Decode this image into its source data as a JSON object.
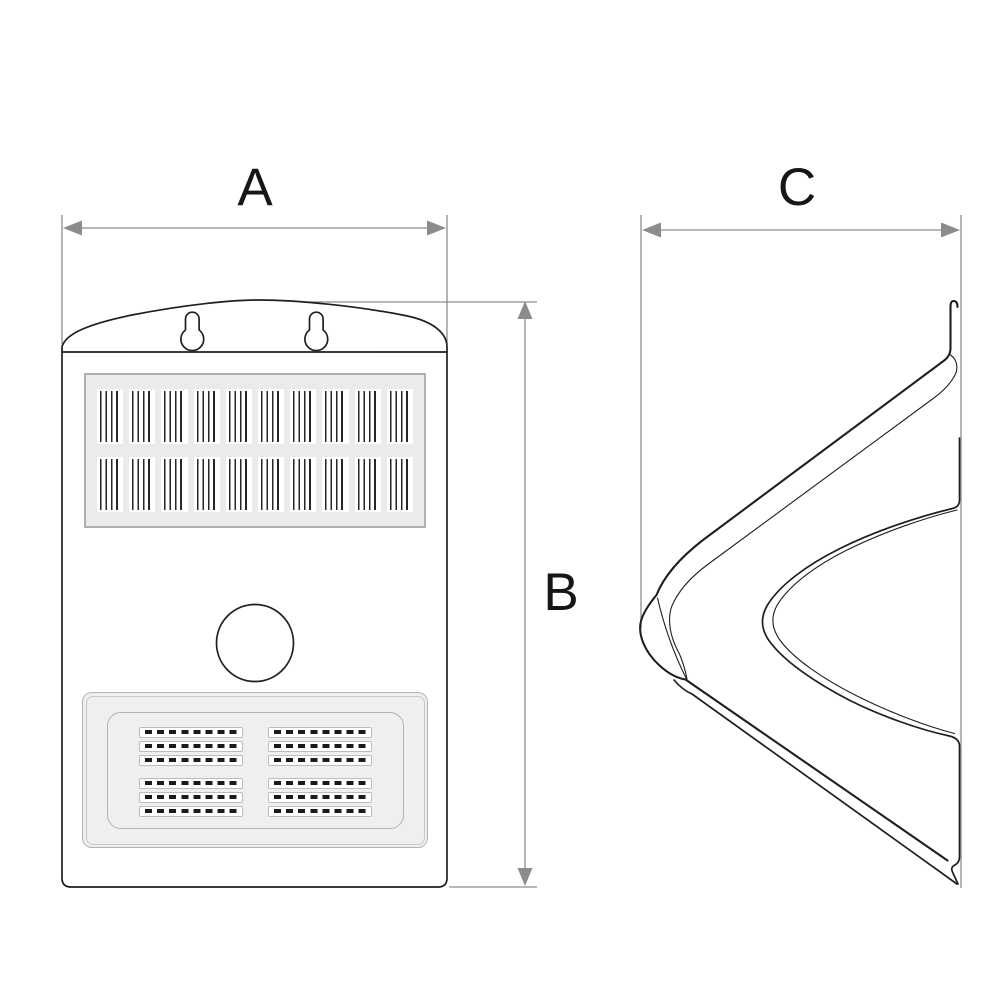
{
  "dimension_labels": {
    "a": "A",
    "b": "B",
    "c": "C"
  },
  "colors": {
    "line": "#1f1f1f",
    "dimension": "#8c8c8c",
    "label_text": "#161616",
    "panel_fill": "#ebebeb",
    "panel_border": "#b0b0b0",
    "cell_fill": "#ffffff",
    "stripe": "#262626",
    "grille_fill": "#efefef",
    "grille_border": "#b3b3b3",
    "strip_fill": "#ffffff",
    "strip_border": "#bdbdbd",
    "block": "#1a1a1a",
    "background": "#ffffff"
  }
}
